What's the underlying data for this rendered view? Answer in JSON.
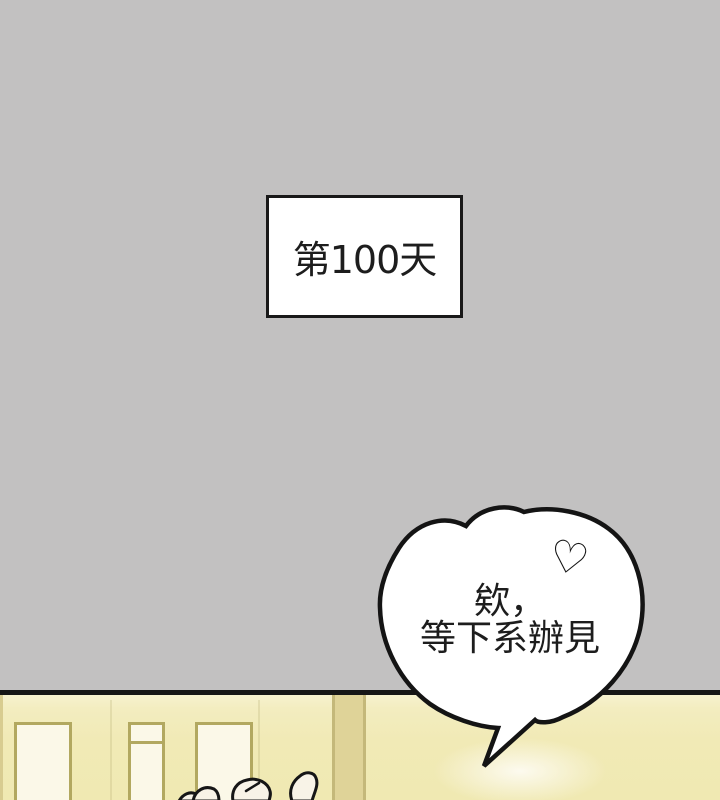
{
  "caption_box": {
    "text": "第100天"
  },
  "speech_bubble": {
    "text_line1": "欸，",
    "text_line2": "等下系辦見",
    "heart_icon": "♡"
  },
  "colors": {
    "background_gray": "#c2c1c1",
    "ink_black": "#161616",
    "bubble_fill": "#ffffff",
    "wall_yellow": "#f1eab6",
    "door_fill": "#fbf8e8",
    "door_frame_olive": "#b2a860",
    "skin_cream": "#f8f3e7"
  }
}
